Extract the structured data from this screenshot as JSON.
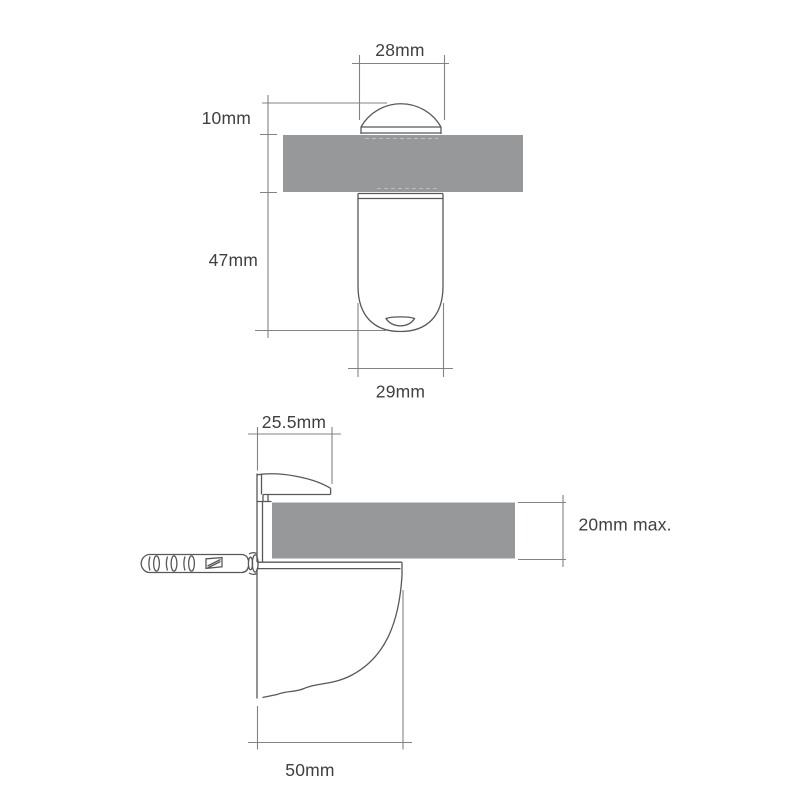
{
  "drawing_title": "glass shelf bracket dimension drawing",
  "colors": {
    "bg": "#ffffff",
    "line": "#57585c",
    "dim": "#828387",
    "hidden": "#c3c4c6",
    "shelf": "#97989a",
    "text": "#3f4043"
  },
  "front_view": {
    "dim_top_width": "28mm",
    "dim_cap_height": "10mm",
    "dim_stem_length": "47mm",
    "dim_stem_width": "29mm"
  },
  "side_view": {
    "dim_clamp_depth": "25.5mm",
    "dim_shelf_thickness": "20mm max.",
    "dim_bracket_depth": "50mm"
  }
}
